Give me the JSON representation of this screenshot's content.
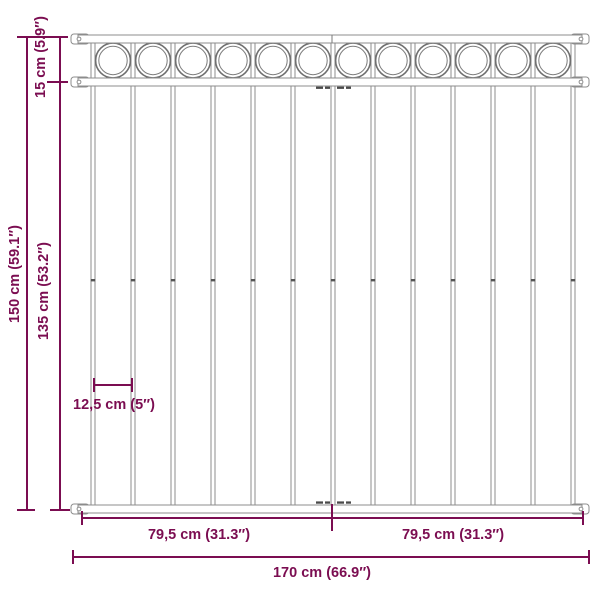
{
  "diagram": {
    "type": "fence-panel-dimension-drawing",
    "accent_color": "#7b0d51",
    "steel_color": "#8c8c8c",
    "labels": {
      "total_height": "150 cm (59.1″)",
      "top_section_height": "15 cm (5.9″)",
      "lower_section_height": "135 cm (53.2″)",
      "bar_spacing": "12,5 cm (5″)",
      "left_half_width": "79,5 cm (31.3″)",
      "right_half_width": "79,5 cm (31.3″)",
      "total_width": "170 cm (66.9″)"
    },
    "structure": {
      "ring_count": 12,
      "bar_count": 13,
      "rail_count": 3,
      "bracket_count": 6
    }
  }
}
